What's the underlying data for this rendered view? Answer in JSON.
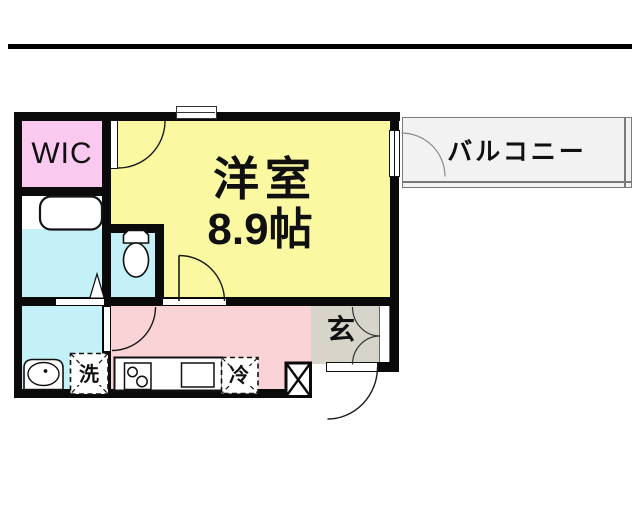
{
  "plan": {
    "wic_label": "WIC",
    "room_label": "洋室",
    "room_size": "8.9帖",
    "balcony_label": "バルコニー",
    "entrance_label": "玄",
    "washer_label": "洗",
    "fridge_label": "冷"
  },
  "colors": {
    "wall": "#0a0a0a",
    "wic": "#f9c9f0",
    "western_room": "#fbf8a2",
    "wet_area": "#c4f0f7",
    "kitchen": "#fad3d6",
    "entrance": "#d7d4ca",
    "balcony_fill": "#f2f2f2",
    "balcony_border": "#7a7a7a"
  }
}
